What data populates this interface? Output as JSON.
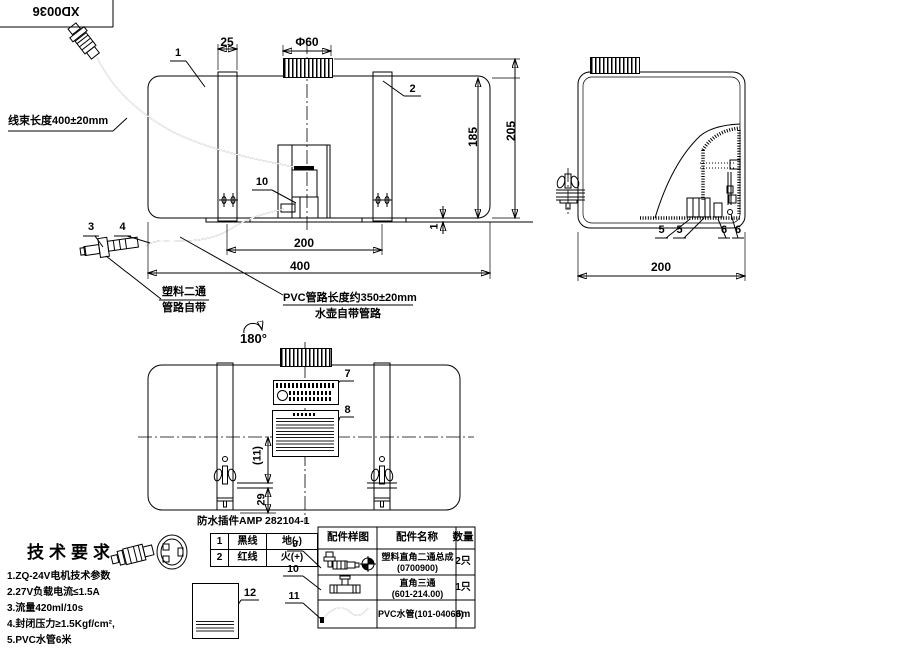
{
  "title_block": {
    "drawing_no": "XD0036"
  },
  "front_view": {
    "wire_note": "线束长度400±20mm",
    "plastic_note": [
      "塑料二通",
      "管路自带"
    ],
    "pvc_note": [
      "PVC管路长度约350±20mm",
      "水壶自带管路"
    ],
    "balloons": {
      "b1": "1",
      "b2": "2",
      "b3": "3",
      "b4": "4",
      "b10": "10"
    },
    "dims": {
      "phi60": "Φ60",
      "d25": "25",
      "d200": "200",
      "d400": "400",
      "d185": "185",
      "d205": "205",
      "d1": "1"
    }
  },
  "side_view": {
    "balloons": {
      "b5a": "5",
      "b5b": "5",
      "b6a": "6",
      "b6b": "6"
    },
    "dims": {
      "d200": "200"
    }
  },
  "rear_view": {
    "rotation_label": "180°",
    "balloons": {
      "b7": "7",
      "b8": "8"
    },
    "dims": {
      "d11": "(11)",
      "d29": "29"
    }
  },
  "connector_detail": {
    "title": "防水插件AMP 282104-1",
    "pins": [
      {
        "no": "1",
        "wire": "黑线",
        "fn": "地(-)"
      },
      {
        "no": "2",
        "wire": "红线",
        "fn": "火(+)"
      }
    ]
  },
  "tech_req": {
    "heading": "技术要求",
    "items": [
      "1.ZQ-24V电机技术参数",
      "2.27V负载电流≤1.5A",
      "3.流量420ml/10s",
      "4.封闭压力≥1.5Kgf/cm²,",
      "5.PVC水管6米"
    ],
    "balloon12": "12"
  },
  "parts_table": {
    "headers": [
      "配件样图",
      "配件名称",
      "数量"
    ],
    "rows": [
      {
        "name": "塑料直角二通总成",
        "code": "(0700900)",
        "qty": "2只"
      },
      {
        "name": "直角三通",
        "code": "(601-214.00)",
        "qty": "1只"
      },
      {
        "name": "PVC水管(101-04068)",
        "code": "",
        "qty": "6m"
      }
    ],
    "balloons": [
      "9",
      "10",
      "11"
    ]
  }
}
